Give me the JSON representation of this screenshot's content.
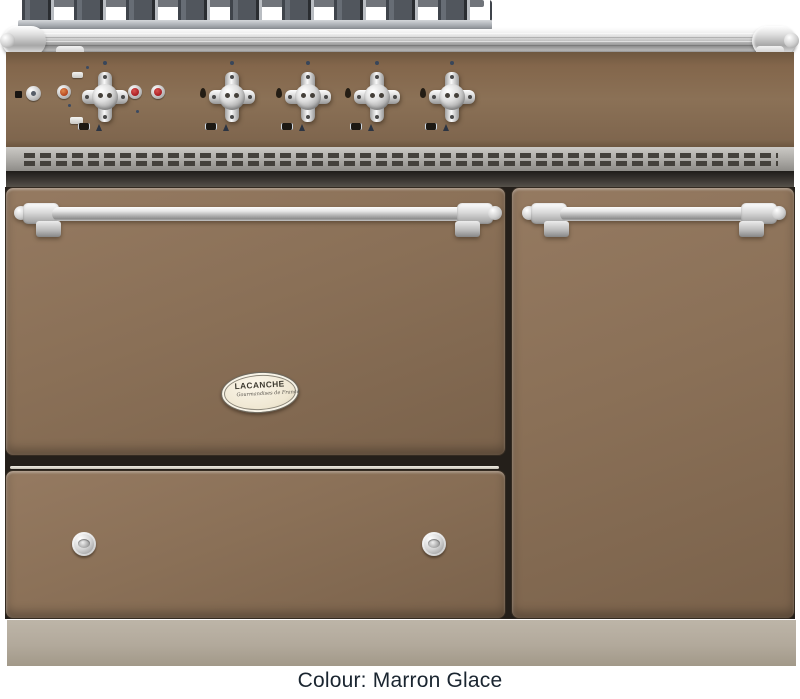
{
  "product_photo": {
    "badge": {
      "brand": "LACANCHE",
      "tagline": "Gourmandises de France"
    },
    "caption": "Colour: Marron Glace"
  },
  "palette": {
    "enamel_brown": "#8a7057",
    "enamel_brown_dark": "#7a624b",
    "control_panel_brown": "#85694f",
    "plinth_taupe": "#b2a99b",
    "chrome_highlight": "#f5f5f5",
    "chrome_shadow": "#8f8f8f",
    "grate_iron": "#51565d",
    "vent_steel": "#aeaca8",
    "vent_slot": "#44413c",
    "indicator_red": "#a81d22",
    "indicator_amber": "#b5451f",
    "badge_cream": "#f2ead8",
    "caption_text": "#1a2530",
    "background": "#ffffff"
  },
  "controls": {
    "burner_knob_count": 4,
    "oven_knob_count": 1,
    "red_indicator_count": 2,
    "amber_indicator_count": 1,
    "drawer_knob_count": 2
  }
}
